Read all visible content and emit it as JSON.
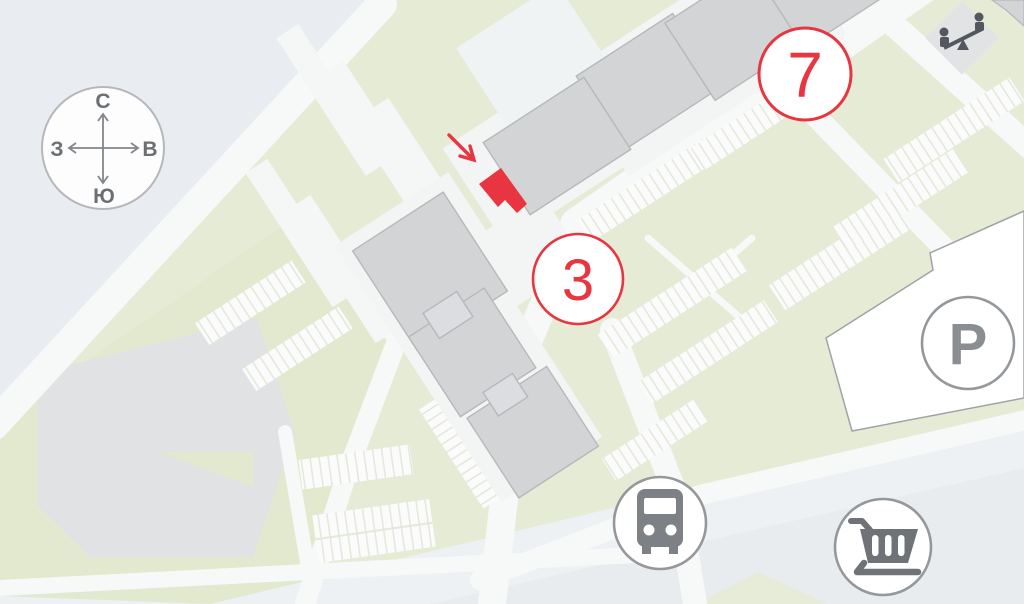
{
  "title": "residential complex site plan",
  "compass": {
    "north": "С",
    "south": "Ю",
    "west": "З",
    "east": "В"
  },
  "buildings": [
    {
      "number": "7",
      "name": "building-7"
    },
    {
      "number": "3",
      "name": "building-3"
    }
  ],
  "selection": {
    "building": "3",
    "kind": "highlighted-section"
  },
  "markers": {
    "parking_label": "P",
    "bus_stop": "bus-icon",
    "shopping": "shopping-cart-icon",
    "playground": "playground-icon"
  },
  "colors": {
    "accent_red": "#e8353f",
    "building_fill": "#d3d4d6",
    "building_stroke": "#b7b8bb",
    "green": "#e5ebd5",
    "outside_gray": "#e9edf2",
    "road_white": "#f7f9f9",
    "icon_gray": "#7d8084",
    "circle_stroke_gray": "#95989b"
  }
}
